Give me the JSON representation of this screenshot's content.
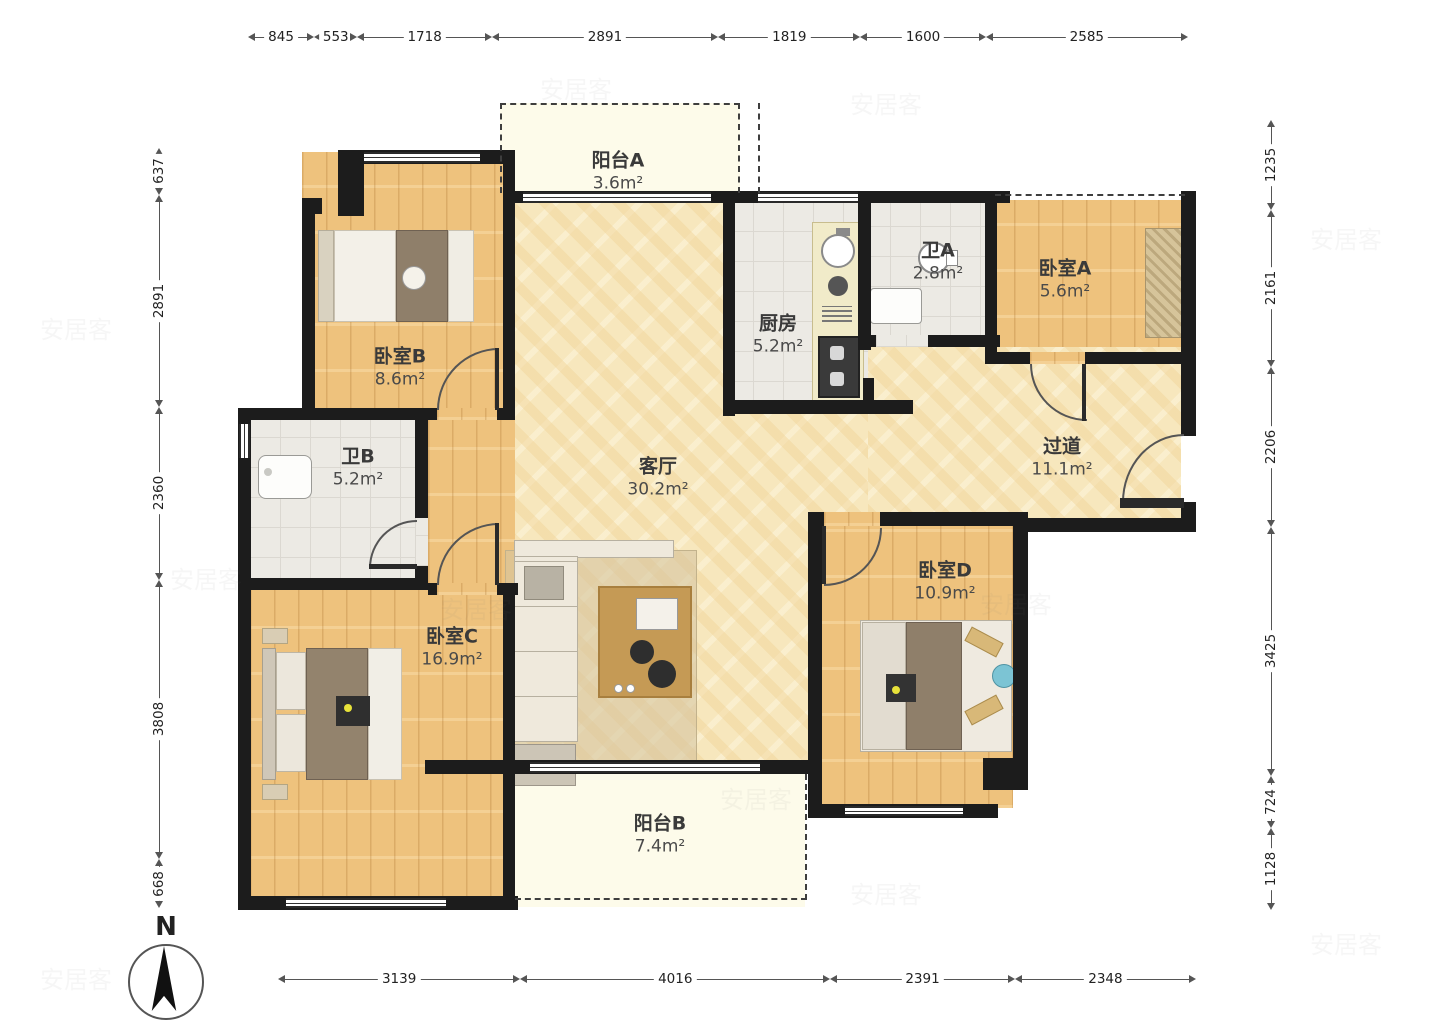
{
  "dimensions": {
    "top": [
      "845",
      "553",
      "1718",
      "2891",
      "1819",
      "1600",
      "2585"
    ],
    "bottom": [
      "3139",
      "4016",
      "2391",
      "2348"
    ],
    "left": [
      "637",
      "2891",
      "2360",
      "3808",
      "668"
    ],
    "right": [
      "1235",
      "2161",
      "2206",
      "3425",
      "724",
      "1128"
    ]
  },
  "rooms": [
    {
      "id": "balcony-a",
      "name": "阳台A",
      "area": "3.6m²"
    },
    {
      "id": "bedroom-b",
      "name": "卧室B",
      "area": "8.6m²"
    },
    {
      "id": "bath-b",
      "name": "卫B",
      "area": "5.2m²"
    },
    {
      "id": "bedroom-c",
      "name": "卧室C",
      "area": "16.9m²"
    },
    {
      "id": "living-room",
      "name": "客厅",
      "area": "30.2m²"
    },
    {
      "id": "kitchen",
      "name": "厨房",
      "area": "5.2m²"
    },
    {
      "id": "bath-a",
      "name": "卫A",
      "area": "2.8m²"
    },
    {
      "id": "bedroom-a",
      "name": "卧室A",
      "area": "5.6m²"
    },
    {
      "id": "hallway",
      "name": "过道",
      "area": "11.1m²"
    },
    {
      "id": "bedroom-d",
      "name": "卧室D",
      "area": "10.9m²"
    },
    {
      "id": "balcony-b",
      "name": "阳台B",
      "area": "7.4m²"
    }
  ],
  "compass": {
    "label": "N"
  },
  "watermark": "安居客"
}
